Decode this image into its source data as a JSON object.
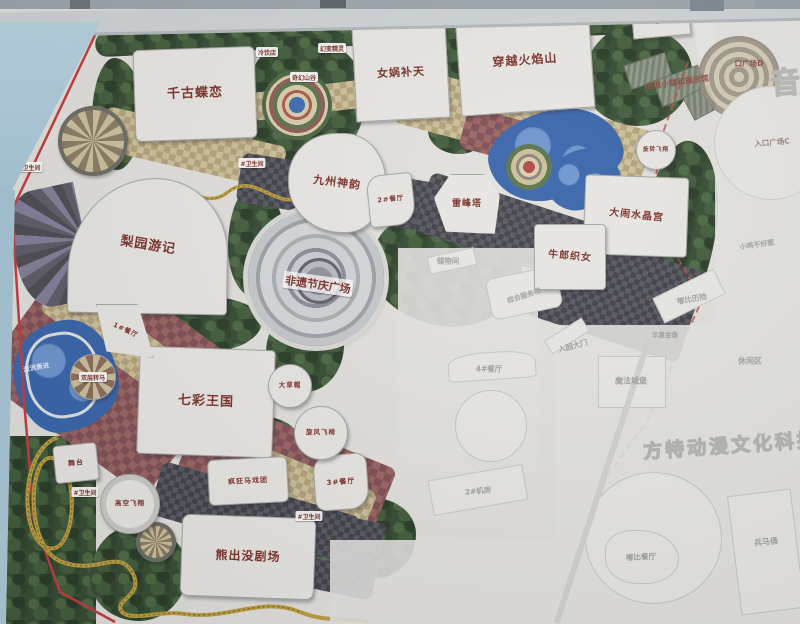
{
  "labels": {
    "qiangu_dielian": "千古蝶恋",
    "nvwa_butian": "女娲补天",
    "chuanyue_huoyanshan": "穿越火焰山",
    "jiuzhou_shenyun": "九州神韵",
    "leifengta": "雷峰塔",
    "danao_shuijinggong": "大闹水晶宫",
    "niulang_zhinv": "牛郎织女",
    "liyuan_youji": "梨园游记",
    "feiyi_jieqing_guangchang": "非遗节庆广场",
    "qicai_wangguo": "七彩王国",
    "xiongchumo_juchang": "熊出没剧场",
    "jiliu_yongjin": "激流勇进",
    "gaokong_feixiang": "高空飞翔",
    "xuanfeng_feiyi": "旋风飞椅",
    "fengkuang_maxituan": "疯狂马戏团",
    "shuangceng_zhuanma": "双层转马",
    "wutai": "舞台",
    "dacaomao": "大草帽",
    "xuanzhuan_feixiang": "旋转飞翔",
    "qihuan_shangu": "奇幻山谷",
    "lengyindian": "冷饮店",
    "huanbian_jingling": "幻变精灵",
    "canting_1": "1#餐厅",
    "canting_2": "2#餐厅",
    "canting_3": "3#餐厅",
    "canting_4": "4#餐厅",
    "jifang_2": "2#机房",
    "zongcang": "总仓",
    "chuwujian": "储物间",
    "zonghe_fuwulou": "综合服务楼",
    "ruyuan_damen": "入园大门",
    "weishengjian": "#卫生间",
    "feiyi_xiaozhen": "非遗小镇和展示馆",
    "rukou_c": "入口广场C",
    "rukou_d": "口广场D",
    "rukou_e": "口广场E",
    "mofa_chengbao": "魔法城堡",
    "dubi_lixian": "嘟比历险",
    "xiaoji_buhaore": "小鸡不好惹",
    "xiuxianqu": "休闲区",
    "dubi_canting": "嘟比餐厅",
    "bingmayong": "兵马俑",
    "huaxia_jinxiang": "华夏金像",
    "watermark_main": "方特动漫文化科技",
    "watermark_side": "音"
  },
  "colors": {
    "attraction_text": "#7a2f26",
    "faded_text": "#a2a19d",
    "water": "#3562a9",
    "path_dark": "#47474f",
    "checker_tan": "#cbbf98",
    "checker_maroon": "#7e4c52",
    "boundary_red": "#c0393b"
  }
}
